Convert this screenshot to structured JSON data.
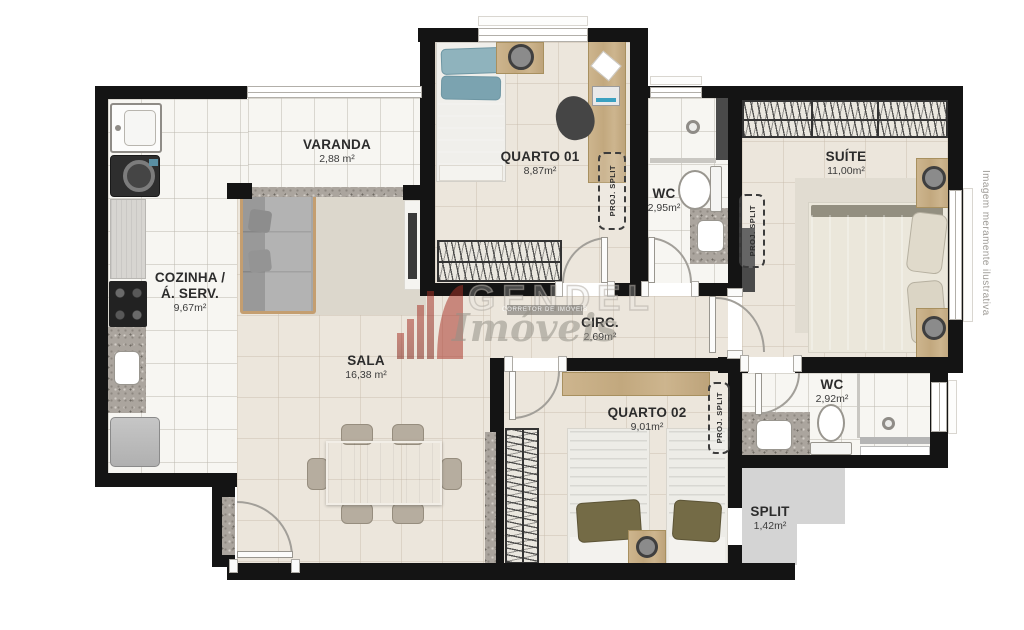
{
  "rooms": {
    "varanda": {
      "name": "VARANDA",
      "area": "2,88 m²"
    },
    "cozinha": {
      "line1": "COZINHA /",
      "line2": "Á. SERV.",
      "area": "9,67m²"
    },
    "quarto01": {
      "name": "QUARTO 01",
      "area": "8,87m²"
    },
    "wc1": {
      "name": "WC",
      "area": "2,95m²"
    },
    "suite": {
      "name": "SUÍTE",
      "area": "11,00m²"
    },
    "sala": {
      "name": "SALA",
      "area": "16,38 m²"
    },
    "circ": {
      "name": "CIRC.",
      "area": "2,69m²"
    },
    "quarto02": {
      "name": "QUARTO 02",
      "area": "9,01m²"
    },
    "wc2": {
      "name": "WC",
      "area": "2,92m²"
    },
    "split": {
      "name": "SPLIT",
      "area": "1,42m²"
    }
  },
  "annotations": {
    "proj_split": "PROJ. SPLIT"
  },
  "watermark": {
    "brand": "GENDEL",
    "tagline": "CORRETOR DE IMÓVEIS",
    "script": "Imóveis"
  },
  "disclaimer": "Imagem meramente ilustrativa",
  "colors": {
    "wall": "#141414",
    "floor_tile": "#f7f6f2",
    "floor_warm": "#ece6dc",
    "split_gray": "#d4d4d4",
    "granite": "#aba59e",
    "label": "#2c2c2c",
    "watermark_red": "#a93226",
    "disclaimer": "#9e9b96"
  }
}
